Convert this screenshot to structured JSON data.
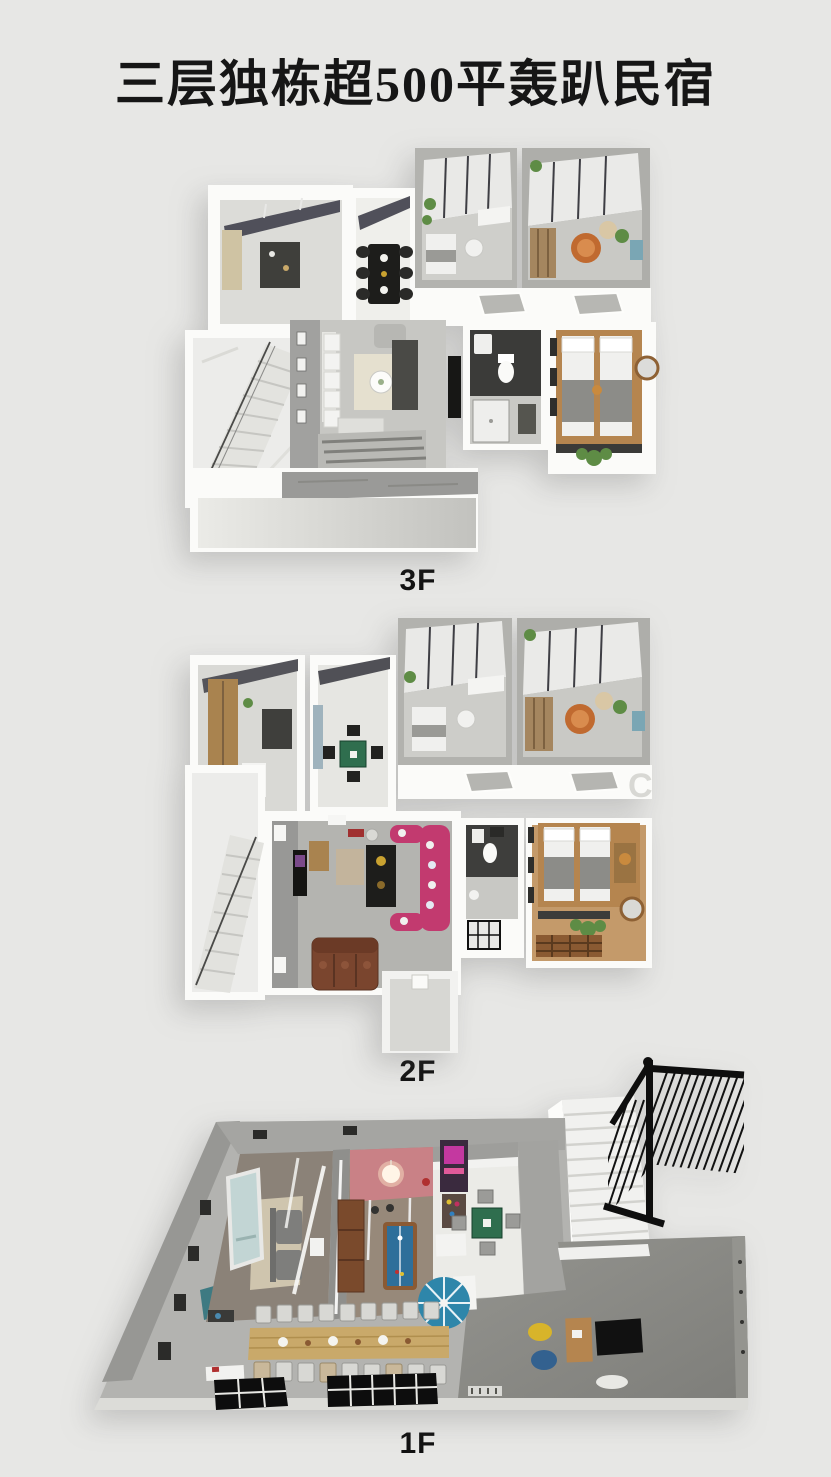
{
  "page": {
    "background": "#e7e7e5"
  },
  "title": {
    "text": "三层独栋超500平轰趴民宿"
  },
  "floors": [
    {
      "label": "3F"
    },
    {
      "label": "2F"
    },
    {
      "label": "1F"
    }
  ],
  "watermark": {
    "text": "C"
  },
  "colors": {
    "title_text": "#161616",
    "label_text": "#121212",
    "plate_white": "#fbfbf9",
    "concrete_gray": "#a5a5a2",
    "marble_white": "#ececea",
    "wood_bed": "#b5854f",
    "wood_table": "#c9a96a",
    "mahjong_green": "#2f6e4e",
    "billiard_blue": "#2e6f9a",
    "ktv_sofa_pink": "#c23a6f",
    "leather_sofa_brown": "#7a452e",
    "pink_wall": "#c98186",
    "arcade_magenta": "#c438a0",
    "projection_screen": "#c2d5d4",
    "bean_bag_yellow": "#d8b42a",
    "bean_bag_blue": "#33618f",
    "spiral_stair_blue": "#2e86aa",
    "plant_green": "#5e8c45",
    "railing_black": "#0e0e0e"
  }
}
